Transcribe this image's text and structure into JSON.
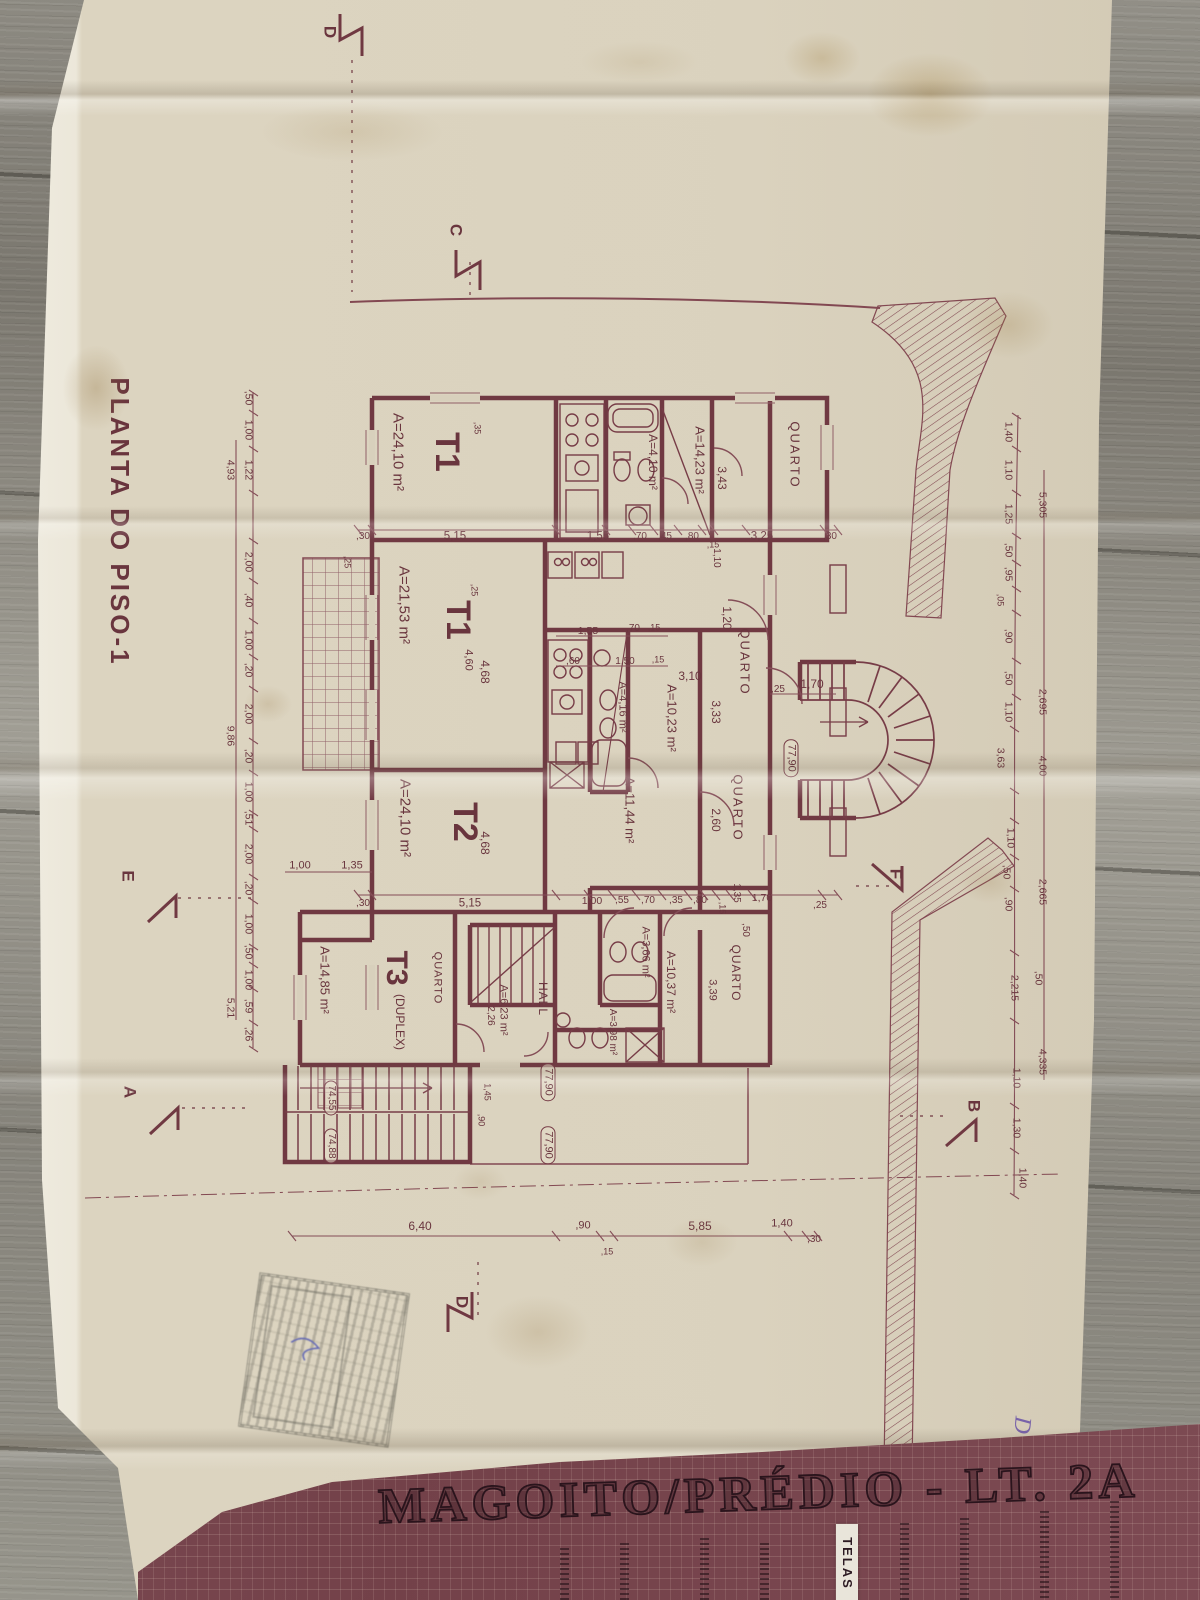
{
  "colors": {
    "ink": "#6d2e3e",
    "ink_thin": "#7c4150",
    "paper": "#ddd6c4",
    "paper_edge": "#f3f1e9",
    "band_background": "#7b4a53",
    "band_ink": "#2a141c",
    "wood": "#8a8984",
    "pen_purple": "#6e58ab"
  },
  "title_block": {
    "project": "MAGOITO/PRÉDIO - LT. 2A",
    "tag": "TELAS"
  },
  "plan": {
    "title": "PLANTA DO PISO-1",
    "labels": [
      {
        "n": "plan-title",
        "t": "PLANTA DO PISO-1",
        "x": 120,
        "y": 522,
        "r": 90,
        "s": 26,
        "w": 700,
        "ls": 3
      },
      {
        "n": "room-t1-top",
        "t": "T1",
        "x": 447,
        "y": 452,
        "r": 90,
        "s": 34,
        "w": 700
      },
      {
        "n": "area-t1-top",
        "t": "A=24,10 m²",
        "x": 398,
        "y": 452,
        "r": 90,
        "s": 15
      },
      {
        "n": "area-1423",
        "t": "A=14,23 m²",
        "x": 700,
        "y": 460,
        "r": 90,
        "s": 13
      },
      {
        "n": "room-quarto-top",
        "t": "QUARTO",
        "x": 795,
        "y": 455,
        "r": 90,
        "s": 13,
        "ls": 2
      },
      {
        "t": "3,43",
        "x": 722,
        "y": 478,
        "r": 90,
        "s": 12
      },
      {
        "n": "area-bath-top",
        "t": "A=4,10 m²",
        "x": 653,
        "y": 462,
        "r": 90,
        "s": 12
      },
      {
        "n": "room-t1-mid",
        "t": "T1",
        "x": 458,
        "y": 620,
        "r": 90,
        "s": 34,
        "w": 700
      },
      {
        "n": "area-t1-mid",
        "t": "A=21,53 m²",
        "x": 404,
        "y": 605,
        "r": 90,
        "s": 15
      },
      {
        "n": "room-quarto-mid1",
        "t": "QUARTO",
        "x": 745,
        "y": 662,
        "r": 90,
        "s": 13,
        "ls": 2
      },
      {
        "n": "area-1023",
        "t": "A=10,23 m²",
        "x": 672,
        "y": 718,
        "r": 90,
        "s": 13
      },
      {
        "t": "3,33",
        "x": 716,
        "y": 712,
        "r": 90,
        "s": 12
      },
      {
        "t": "3,10",
        "x": 690,
        "y": 676,
        "r": 0,
        "s": 12
      },
      {
        "t": "1,20",
        "x": 727,
        "y": 618,
        "r": 90,
        "s": 12
      },
      {
        "t": "1,70",
        "x": 812,
        "y": 684,
        "r": 0,
        "s": 12
      },
      {
        "n": "area-bath-mid",
        "t": "A=4,16 m²",
        "x": 622,
        "y": 707,
        "r": 90,
        "s": 11
      },
      {
        "n": "area-1144",
        "t": "A=11,44 m²",
        "x": 630,
        "y": 810,
        "r": 90,
        "s": 13
      },
      {
        "n": "room-t2",
        "t": "T2",
        "x": 465,
        "y": 822,
        "r": 90,
        "s": 34,
        "w": 700
      },
      {
        "n": "area-t2",
        "t": "A=24,10 m²",
        "x": 405,
        "y": 818,
        "r": 90,
        "s": 15
      },
      {
        "n": "room-quarto-mid2",
        "t": "QUARTO",
        "x": 738,
        "y": 808,
        "r": 90,
        "s": 13,
        "ls": 2
      },
      {
        "t": "2,60",
        "x": 716,
        "y": 820,
        "r": 90,
        "s": 12
      },
      {
        "n": "room-t3",
        "t": "T3",
        "x": 396,
        "y": 968,
        "r": 90,
        "s": 30,
        "w": 700
      },
      {
        "n": "room-t3-duplex",
        "t": "(DUPLEX)",
        "x": 400,
        "y": 1022,
        "r": 90,
        "s": 12
      },
      {
        "n": "area-t3",
        "t": "A=14,85 m²",
        "x": 325,
        "y": 980,
        "r": 90,
        "s": 13
      },
      {
        "n": "room-quarto-t3",
        "t": "QUARTO",
        "x": 437,
        "y": 978,
        "r": 90,
        "s": 11,
        "ls": 1
      },
      {
        "n": "area-623",
        "t": "A=6,23 m²",
        "x": 503,
        "y": 1010,
        "r": 90,
        "s": 11
      },
      {
        "t": "2,26",
        "x": 490,
        "y": 1016,
        "r": 90,
        "s": 10
      },
      {
        "n": "room-hall",
        "t": "HALL",
        "x": 543,
        "y": 999,
        "r": 90,
        "s": 12,
        "ls": 1
      },
      {
        "n": "area-366",
        "t": "A=3,66 m²",
        "x": 645,
        "y": 952,
        "r": 90,
        "s": 11
      },
      {
        "n": "area-1037",
        "t": "A=10,37 m²",
        "x": 671,
        "y": 982,
        "r": 90,
        "s": 12
      },
      {
        "n": "area-398",
        "t": "A=3,98 m²",
        "x": 612,
        "y": 1032,
        "r": 90,
        "s": 10
      },
      {
        "n": "room-quarto-bot",
        "t": "QUARTO",
        "x": 736,
        "y": 973,
        "r": 90,
        "s": 12,
        "ls": 1
      },
      {
        "t": "3,39",
        "x": 712,
        "y": 990,
        "r": 90,
        "s": 11
      },
      {
        "n": "elevation-7790-a",
        "t": "77,90",
        "x": 791,
        "y": 758,
        "r": 90,
        "s": 11,
        "box": true
      },
      {
        "n": "elevation-7790-b",
        "t": "77,90",
        "x": 548,
        "y": 1082,
        "r": 90,
        "s": 11,
        "box": true
      },
      {
        "n": "elevation-7790-c",
        "t": "77,90",
        "x": 548,
        "y": 1145,
        "r": 90,
        "s": 11,
        "box": true
      },
      {
        "n": "elevation-7455",
        "t": "74,55",
        "x": 331,
        "y": 1098,
        "r": 90,
        "s": 10,
        "box": true
      },
      {
        "n": "elevation-7488",
        "t": "74,88",
        "x": 331,
        "y": 1146,
        "r": 90,
        "s": 10,
        "box": true
      },
      {
        "n": "section-marker-d-top",
        "t": "D",
        "x": 330,
        "y": 32,
        "r": 90,
        "s": 17,
        "w": 700
      },
      {
        "n": "section-marker-c",
        "t": "C",
        "x": 456,
        "y": 230,
        "r": 90,
        "s": 17,
        "w": 700
      },
      {
        "n": "section-marker-e",
        "t": "E",
        "x": 128,
        "y": 876,
        "r": 90,
        "s": 17,
        "w": 700
      },
      {
        "n": "section-marker-f",
        "t": "F",
        "x": 896,
        "y": 874,
        "r": 90,
        "s": 17,
        "w": 700
      },
      {
        "n": "section-marker-a",
        "t": "A",
        "x": 130,
        "y": 1092,
        "r": 90,
        "s": 17,
        "w": 700
      },
      {
        "n": "section-marker-b",
        "t": "B",
        "x": 974,
        "y": 1106,
        "r": 90,
        "s": 17,
        "w": 700
      },
      {
        "n": "section-marker-d-bottom",
        "t": "D",
        "x": 462,
        "y": 1302,
        "r": 90,
        "s": 17,
        "w": 700
      },
      {
        "n": "handwritten-d",
        "t": "D",
        "x": 1022,
        "y": 1425,
        "r": 95,
        "s": 24,
        "w": 400,
        "c": "#6e58ab",
        "f": "serif"
      },
      {
        "t": ",30",
        "x": 363,
        "y": 537,
        "r": 0,
        "s": 10
      },
      {
        "t": "5,15",
        "x": 455,
        "y": 537,
        "r": 0,
        "s": 11.5
      },
      {
        "t": "1,55",
        "x": 598,
        "y": 537,
        "r": 0,
        "s": 11.5
      },
      {
        "t": ",70",
        "x": 640,
        "y": 537,
        "r": 0,
        "s": 10
      },
      {
        "t": ",45",
        "x": 665,
        "y": 537,
        "r": 0,
        "s": 10
      },
      {
        "t": ",80",
        "x": 692,
        "y": 537,
        "r": 0,
        "s": 10
      },
      {
        "t": ",15",
        "x": 713,
        "y": 545,
        "r": 0,
        "s": 9
      },
      {
        "t": "1,10",
        "x": 716,
        "y": 558,
        "r": 90,
        "s": 10
      },
      {
        "t": "3,25",
        "x": 762,
        "y": 537,
        "r": 0,
        "s": 11.5
      },
      {
        "t": ",30",
        "x": 830,
        "y": 537,
        "r": 0,
        "s": 10
      },
      {
        "t": ",35",
        "x": 477,
        "y": 428,
        "r": 90,
        "s": 9
      },
      {
        "t": ",25",
        "x": 347,
        "y": 562,
        "r": 90,
        "s": 9
      },
      {
        "t": ",25",
        "x": 474,
        "y": 590,
        "r": 90,
        "s": 9
      },
      {
        "t": "1,55",
        "x": 588,
        "y": 631,
        "r": 0,
        "s": 10.5
      },
      {
        "t": ",70",
        "x": 633,
        "y": 629,
        "r": 0,
        "s": 10
      },
      {
        "t": ",15",
        "x": 654,
        "y": 628,
        "r": 0,
        "s": 9
      },
      {
        "t": ",60",
        "x": 573,
        "y": 662,
        "r": 0,
        "s": 10
      },
      {
        "t": "1,50",
        "x": 625,
        "y": 662,
        "r": 0,
        "s": 10
      },
      {
        "t": ",15",
        "x": 658,
        "y": 660,
        "r": 0,
        "s": 9
      },
      {
        "t": "4,68",
        "x": 485,
        "y": 672,
        "r": 90,
        "s": 12
      },
      {
        "t": "4,60",
        "x": 468,
        "y": 660,
        "r": 90,
        "s": 11
      },
      {
        "t": "4,68",
        "x": 485,
        "y": 843,
        "r": 90,
        "s": 12
      },
      {
        "t": "1,00",
        "x": 300,
        "y": 866,
        "r": 0,
        "s": 11
      },
      {
        "t": "1,35",
        "x": 352,
        "y": 866,
        "r": 0,
        "s": 11
      },
      {
        "t": ",30",
        "x": 363,
        "y": 904,
        "r": 0,
        "s": 10
      },
      {
        "t": "5,15",
        "x": 470,
        "y": 904,
        "r": 0,
        "s": 11.5
      },
      {
        "t": "1,00",
        "x": 592,
        "y": 901,
        "r": 0,
        "s": 10.5
      },
      {
        "t": ",55",
        "x": 622,
        "y": 901,
        "r": 0,
        "s": 10
      },
      {
        "t": ",70",
        "x": 648,
        "y": 901,
        "r": 0,
        "s": 10
      },
      {
        "t": ",35",
        "x": 676,
        "y": 901,
        "r": 0,
        "s": 10
      },
      {
        "t": ",80",
        "x": 700,
        "y": 901,
        "r": 0,
        "s": 10
      },
      {
        "t": ",15",
        "x": 722,
        "y": 908,
        "r": 90,
        "s": 9
      },
      {
        "t": "1,35",
        "x": 736,
        "y": 893,
        "r": 90,
        "s": 10
      },
      {
        "t": "1,70",
        "x": 762,
        "y": 898,
        "r": 0,
        "s": 10.5
      },
      {
        "t": ",50",
        "x": 745,
        "y": 930,
        "r": 90,
        "s": 10
      },
      {
        "t": ",25",
        "x": 778,
        "y": 690,
        "r": 0,
        "s": 10
      },
      {
        "t": ",25",
        "x": 820,
        "y": 906,
        "r": 0,
        "s": 10
      },
      {
        "t": "1,45",
        "x": 487,
        "y": 1092,
        "r": 90,
        "s": 9
      },
      {
        "t": ",90",
        "x": 481,
        "y": 1120,
        "r": 90,
        "s": 9
      },
      {
        "t": "6,40",
        "x": 420,
        "y": 1226,
        "r": 0,
        "s": 12
      },
      {
        "t": ",90",
        "x": 583,
        "y": 1226,
        "r": 0,
        "s": 11
      },
      {
        "t": ",15",
        "x": 607,
        "y": 1252,
        "r": 0,
        "s": 9
      },
      {
        "t": "5,85",
        "x": 700,
        "y": 1226,
        "r": 0,
        "s": 12
      },
      {
        "t": "1,40",
        "x": 782,
        "y": 1224,
        "r": 0,
        "s": 11
      },
      {
        "t": ",30",
        "x": 814,
        "y": 1240,
        "r": 0,
        "s": 10
      },
      {
        "t": ",50",
        "x": 248,
        "y": 398,
        "r": 90,
        "s": 10.5
      },
      {
        "t": "1,00",
        "x": 248,
        "y": 430,
        "r": 90,
        "s": 10.5
      },
      {
        "t": "1,22",
        "x": 248,
        "y": 470,
        "r": 90,
        "s": 10.5
      },
      {
        "t": "4,93",
        "x": 230,
        "y": 470,
        "r": 90,
        "s": 10.5
      },
      {
        "t": "2,00",
        "x": 248,
        "y": 562,
        "r": 90,
        "s": 10.5
      },
      {
        "t": ",40",
        "x": 248,
        "y": 600,
        "r": 90,
        "s": 10.5
      },
      {
        "t": "1,00",
        "x": 248,
        "y": 640,
        "r": 90,
        "s": 10.5
      },
      {
        "t": ",20",
        "x": 248,
        "y": 670,
        "r": 90,
        "s": 10.5
      },
      {
        "t": "2,00",
        "x": 248,
        "y": 714,
        "r": 90,
        "s": 10.5
      },
      {
        "t": "9,86",
        "x": 230,
        "y": 736,
        "r": 90,
        "s": 10.5
      },
      {
        "t": ",20",
        "x": 248,
        "y": 756,
        "r": 90,
        "s": 10.5
      },
      {
        "t": "1,00",
        "x": 248,
        "y": 792,
        "r": 90,
        "s": 10.5
      },
      {
        "t": ",51",
        "x": 248,
        "y": 818,
        "r": 90,
        "s": 10.5
      },
      {
        "t": "2,00",
        "x": 248,
        "y": 854,
        "r": 90,
        "s": 10.5
      },
      {
        "t": ",20",
        "x": 248,
        "y": 888,
        "r": 90,
        "s": 10.5
      },
      {
        "t": "1,00",
        "x": 248,
        "y": 924,
        "r": 90,
        "s": 10.5
      },
      {
        "t": ",50",
        "x": 248,
        "y": 952,
        "r": 90,
        "s": 10.5
      },
      {
        "t": "1,00",
        "x": 248,
        "y": 980,
        "r": 90,
        "s": 10.5
      },
      {
        "t": ",59",
        "x": 248,
        "y": 1006,
        "r": 90,
        "s": 10.5
      },
      {
        "t": ",26",
        "x": 248,
        "y": 1034,
        "r": 90,
        "s": 10.5
      },
      {
        "t": "5,21",
        "x": 230,
        "y": 1008,
        "r": 90,
        "s": 10.5
      },
      {
        "t": "1,40",
        "x": 1008,
        "y": 432,
        "r": 90,
        "s": 10.5
      },
      {
        "t": "1,10",
        "x": 1008,
        "y": 470,
        "r": 90,
        "s": 10.5
      },
      {
        "t": "1,25",
        "x": 1008,
        "y": 514,
        "r": 90,
        "s": 10.5
      },
      {
        "t": ",50",
        "x": 1008,
        "y": 550,
        "r": 90,
        "s": 10.5
      },
      {
        "t": ",95",
        "x": 1008,
        "y": 574,
        "r": 90,
        "s": 10.5
      },
      {
        "t": ",05",
        "x": 1000,
        "y": 600,
        "r": 90,
        "s": 9
      },
      {
        "t": ",90",
        "x": 1008,
        "y": 636,
        "r": 90,
        "s": 10.5
      },
      {
        "t": ",50",
        "x": 1008,
        "y": 678,
        "r": 90,
        "s": 10.5
      },
      {
        "t": "1,10",
        "x": 1008,
        "y": 712,
        "r": 90,
        "s": 10.5
      },
      {
        "t": "5,305",
        "x": 1042,
        "y": 505,
        "r": 90,
        "s": 10.5
      },
      {
        "t": "2,695",
        "x": 1042,
        "y": 702,
        "r": 90,
        "s": 10.5
      },
      {
        "t": "3,63",
        "x": 1000,
        "y": 758,
        "r": 90,
        "s": 10.5
      },
      {
        "t": "4,00",
        "x": 1042,
        "y": 766,
        "r": 90,
        "s": 10.5
      },
      {
        "t": "1,10",
        "x": 1010,
        "y": 838,
        "r": 90,
        "s": 10.5
      },
      {
        "t": ",50",
        "x": 1006,
        "y": 872,
        "r": 90,
        "s": 10.5
      },
      {
        "t": ",90",
        "x": 1008,
        "y": 904,
        "r": 90,
        "s": 10.5
      },
      {
        "t": "2,665",
        "x": 1042,
        "y": 892,
        "r": 90,
        "s": 10.5
      },
      {
        "t": "2,215",
        "x": 1014,
        "y": 988,
        "r": 90,
        "s": 10.5
      },
      {
        "t": ",50",
        "x": 1038,
        "y": 978,
        "r": 90,
        "s": 10.5
      },
      {
        "t": "1,10",
        "x": 1016,
        "y": 1078,
        "r": 90,
        "s": 10.5
      },
      {
        "t": "4,335",
        "x": 1042,
        "y": 1062,
        "r": 90,
        "s": 10.5
      },
      {
        "t": "1,30",
        "x": 1016,
        "y": 1128,
        "r": 90,
        "s": 10.5
      },
      {
        "t": "1,40",
        "x": 1022,
        "y": 1178,
        "r": 90,
        "s": 10.5
      }
    ]
  }
}
